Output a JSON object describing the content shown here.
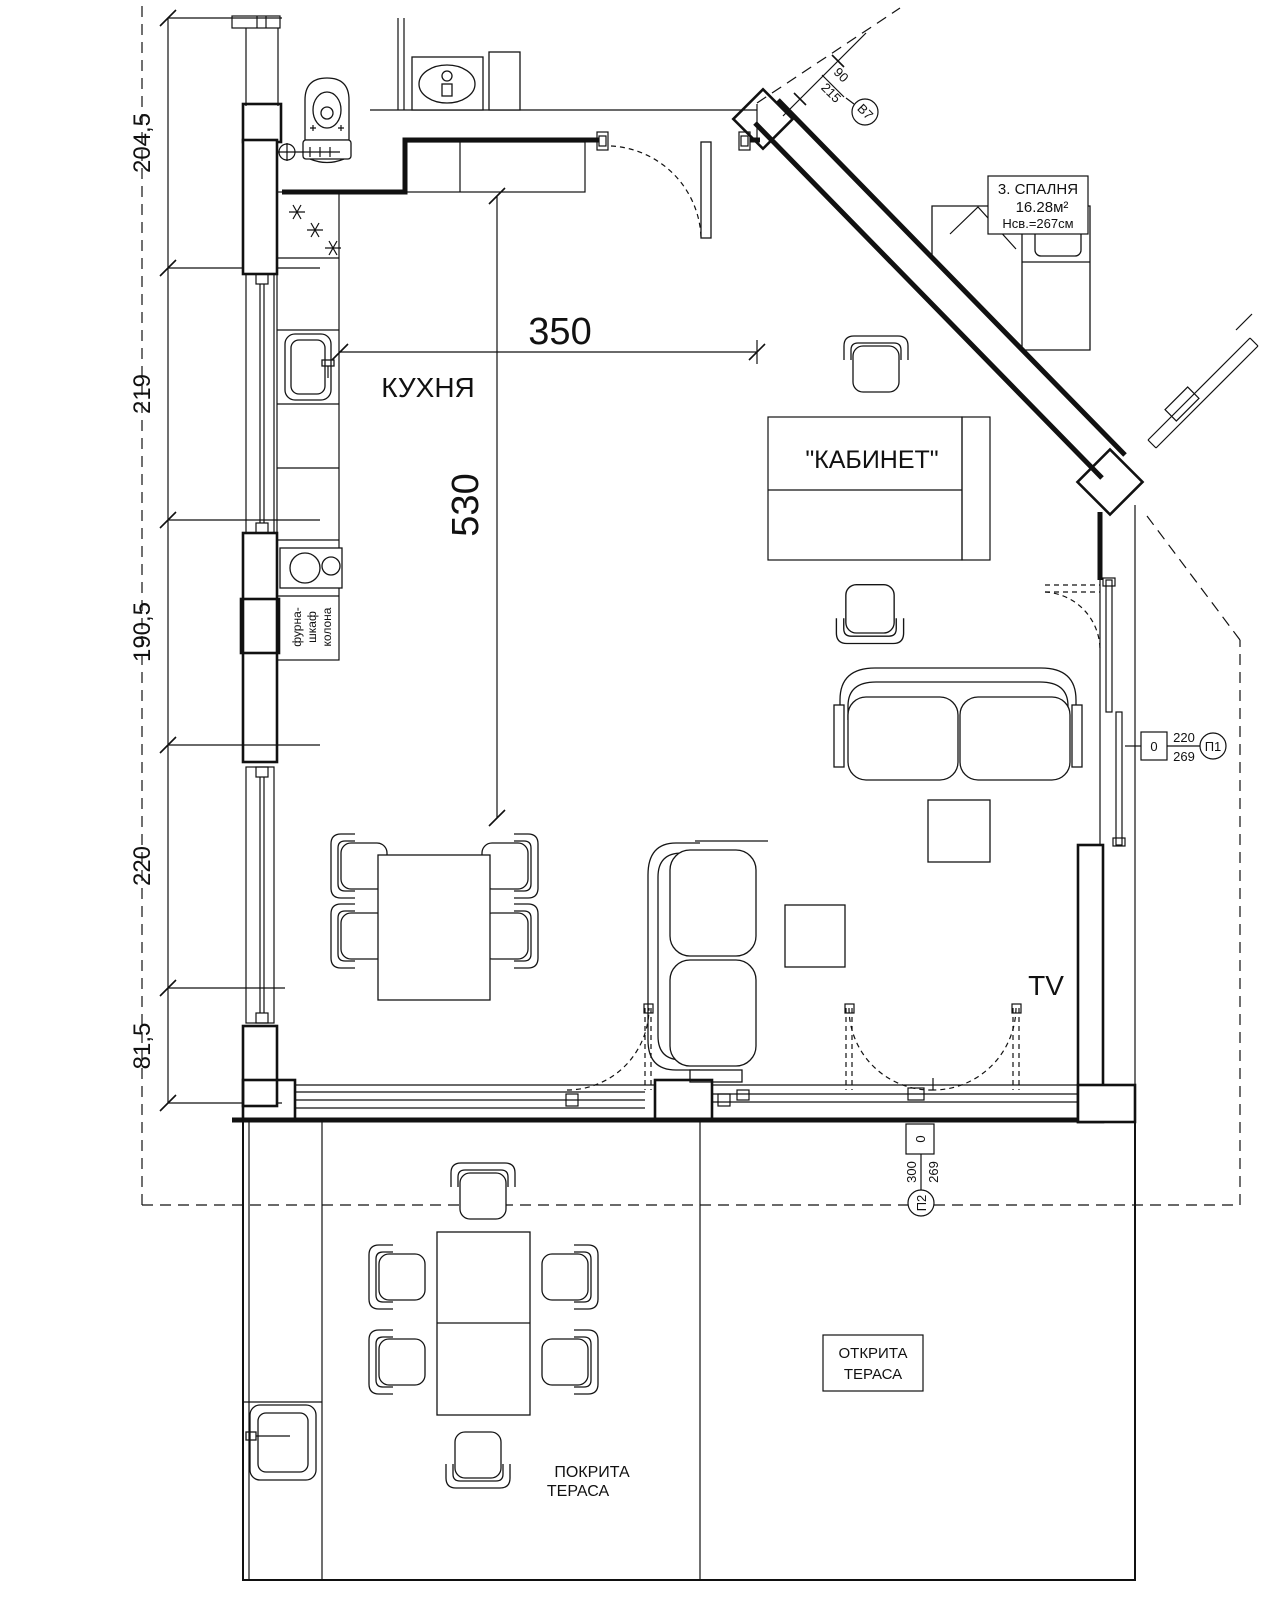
{
  "meta": {
    "background": "#ffffff",
    "line_color": "#111111"
  },
  "dimensions": {
    "left_chain": [
      "204,5",
      "219",
      "190,5",
      "220",
      "81,5"
    ],
    "kitchen_width": "350",
    "kitchen_depth": "530"
  },
  "rooms": {
    "kitchen": "КУХНЯ",
    "cabinet": "\"КАБИНЕТ\"",
    "tv": "TV",
    "covered_terrace": [
      "ПОКРИТА",
      "ТЕРАСА"
    ],
    "open_terrace": [
      "ОТКРИТА",
      "ТЕРАСА"
    ]
  },
  "callouts": {
    "bedroom": {
      "line1": "3. СПАЛНЯ",
      "line2": "16.28м²",
      "line3": "Нсв.=267см"
    },
    "window_b7": {
      "width": "90",
      "height": "215",
      "tag": "В7"
    },
    "door_p1": {
      "offset": "0",
      "width": "220",
      "height": "269",
      "tag": "П1"
    },
    "door_p2": {
      "offset": "0",
      "width": "300",
      "height": "269",
      "tag": "П2"
    },
    "oven_stack": [
      "фурна-",
      "шкаф",
      "колона"
    ]
  }
}
